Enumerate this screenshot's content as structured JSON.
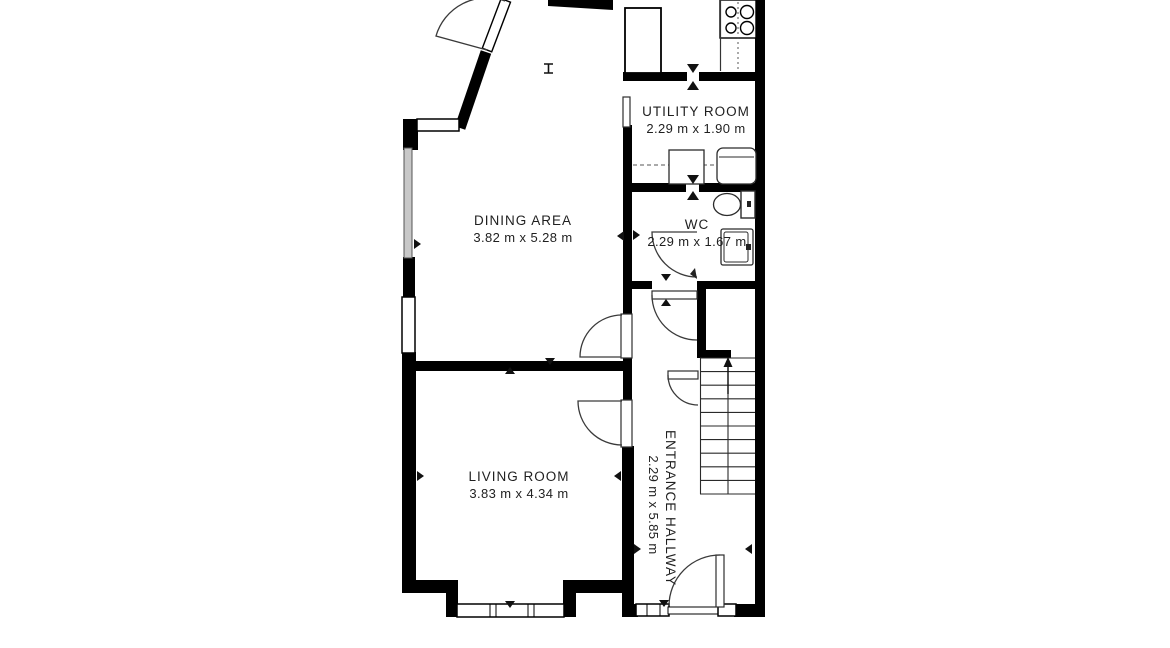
{
  "title": "Ground floor plan",
  "colors": {
    "wall": "#000000",
    "background": "#ffffff",
    "fixture_line": "#3a3a3a",
    "narrow_window_fill": "#c8c8c8"
  },
  "rooms": [
    {
      "name": "UTILITY ROOM",
      "dimensions": "2.29 m x 1.90 m"
    },
    {
      "name": "WC",
      "dimensions": "2.29 m x 1.67 m"
    },
    {
      "name": "DINING AREA",
      "dimensions": "3.82 m x 5.28 m"
    },
    {
      "name": "LIVING ROOM",
      "dimensions": "3.83 m x 4.34 m"
    },
    {
      "name": "ENTRANCE HALLWAY",
      "dimensions": "2.29 m x 5.85 m"
    }
  ],
  "fixtures": [
    "stove-icon",
    "kitchen-cabinet-icon",
    "washer-icon",
    "dryer-icon",
    "toilet-icon",
    "sink-icon",
    "staircase-icon",
    "door-swing-icon",
    "window-icon"
  ]
}
